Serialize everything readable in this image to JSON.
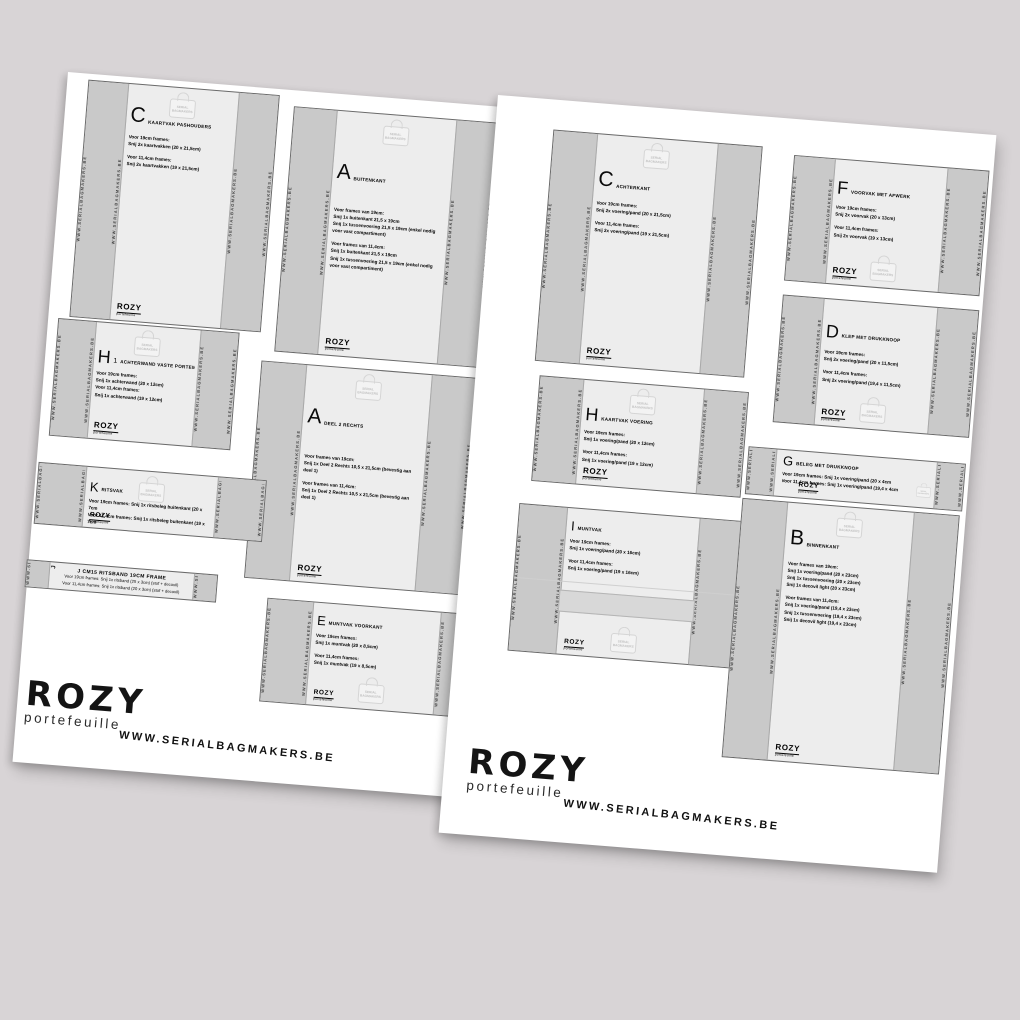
{
  "background": "#d8d4d6",
  "brand": {
    "name": "ROZY",
    "sub": "portefeuille",
    "url": "WWW.SERIALBAGMAKERS.BE"
  },
  "watermark": {
    "label": [
      "SERIAL",
      "BAGMAKERS"
    ]
  },
  "edge_text": "WWW.SERIALBAGMAKERS.BE",
  "pages": {
    "left": {
      "pieces": {
        "c": {
          "letter": "C",
          "title": "Kaartvak pashouders",
          "text1": [
            "Voor 19cm frames:",
            "Snij 2x kaartvakken (20 x 21,5cm)"
          ],
          "text2": [
            "Voor 11,4cm frames:",
            "Snij 2x kaartvakken (19 x 21,5cm)"
          ]
        },
        "a": {
          "letter": "A",
          "title": "Buitenkant",
          "text1": [
            "Voor frames van 19cm:",
            "Snij 1x buitenkant 21,5 x 19cm",
            "Snij 1x tussenvoering 21,5 x 19cm (enkel nodig voor vast compartiment)"
          ],
          "text2": [
            "Voor frames van 11,4cm:",
            "Snij 1x buitenkant 21,5 x 19cm",
            "Snij 1x tussenvoering 21,5 x 19cm (enkel nodig voor vast compartiment)"
          ]
        },
        "h1": {
          "letter": "H",
          "lsub": "1",
          "title": "Achterwand vaste portemonnee",
          "text1": [
            "Voor 19cm frames:",
            "Snij 1x achterwand (20 x 12cm)",
            "Voor 11,4cm frames:",
            "Snij 1x achterwand (19 x 12cm)"
          ]
        },
        "a2": {
          "letter": "A",
          "title": "Deel 2 rechts",
          "text1": [
            "Voor frames van 19cm:",
            "Snij 1x Deel 2 Rechts 10,5 x 21,5cm (bevestig aan deel 1)"
          ],
          "text2": [
            "Voor frames van 11,4cm:",
            "Snij 1x Deel 2 Rechts 10,5 x 21,5cm (bevestig aan deel 1)"
          ]
        },
        "k": {
          "letter": "K",
          "title": "Ritsvak",
          "text1": [
            "Voor 19cm frames: Snij 1x ritsbeleg buitenkant (20 x 7cm",
            "Voor 11,4cm frames: Snij 1x ritsbeleg buitenkant (19 x 7cm"
          ]
        },
        "j": {
          "tag": "J",
          "title": "J CM15 RITSBAND 19CM FRAME",
          "lines": [
            "Voor 19cm frames: Snij 1x ritsband (25 x 3cm) (stof + decovil)",
            "Voor 11,4cm frames: Snij 1x ritsband (20 x 3cm) (stof + decovil)"
          ]
        },
        "e": {
          "letter": "E",
          "title": "Muntvak voorkant",
          "text1": [
            "Voor 19cm frames:",
            "Snij 1x muntvak (20 x 8,5cm)"
          ],
          "text2": [
            "Voor 11,4cm frames:",
            "Snij 1x muntvak (19 x 8,5cm)"
          ]
        }
      }
    },
    "right": {
      "pieces": {
        "c": {
          "letter": "C",
          "title": "Achterkant",
          "text1": [
            "Voor 19cm frames:",
            "Snij 2x voering/pand (20 x 21,5cm)"
          ],
          "text2": [
            "Voor 11,4cm frames:",
            "Snij 2x voering/pand (19 x 21,5cm)"
          ]
        },
        "f": {
          "letter": "F",
          "title": "Voorvak met afwerk",
          "text1": [
            "Voor 19cm frames:",
            "Snij 2x voorvak (20 x 13cm)"
          ],
          "text2": [
            "Voor 11,4cm frames:",
            "Snij 2x voorvak (19 x 13cm)"
          ]
        },
        "d": {
          "letter": "D",
          "title": "Klep met drukknoop",
          "text1": [
            "Voor 19cm frames:",
            "Snij 2x voering/pand (20 x 11,5cm)"
          ],
          "text2": [
            "Voor 11,4cm frames:",
            "Snij 2x voering/pand (19,4 x 11,5cm)"
          ]
        },
        "g": {
          "letter": "G",
          "title": "Beleg met drukknoop",
          "text1": [
            "Voor 19cm frames: Snij 1x voering/pand (20 x 4cm",
            "Voor 11,4cm frames: Snij 1x voering/pand (19,4 x 4cm"
          ]
        },
        "h": {
          "letter": "H",
          "title": "Kaartvak voering",
          "text1": [
            "Voor 19cm frames:",
            "Snij 1x voering/pand (20 x 12cm)"
          ],
          "text2": [
            "Voor 11,4cm frames:",
            "Snij 1x voering/pand (19 x 12cm)"
          ]
        },
        "i": {
          "letter": "I",
          "title": "Muntvak",
          "text1": [
            "Voor 19cm frames:",
            "Snij 1x voering/pand (20 x 16cm)"
          ],
          "text2": [
            "Voor 11,4cm frames:",
            "Snij 1x voering/pand (19 x 16cm)"
          ]
        },
        "b": {
          "letter": "B",
          "title": "Binnenkant",
          "text1": [
            "Voor frames van 19cm:",
            "Snij 1x voering/pand (20 x 23cm)",
            "Snij 1x tussenvoering (20 x 23cm)",
            "Snij 1x decovil light (20 x 23cm)"
          ],
          "text2": [
            "Voor frames van 11,4cm:",
            "Snij 1x voering/pand (19,4 x 23cm)",
            "Snij 1x tussenvoering (19,4 x 23cm)",
            "Snij 1x decovil light (19,4 x 23cm)"
          ]
        }
      }
    }
  }
}
